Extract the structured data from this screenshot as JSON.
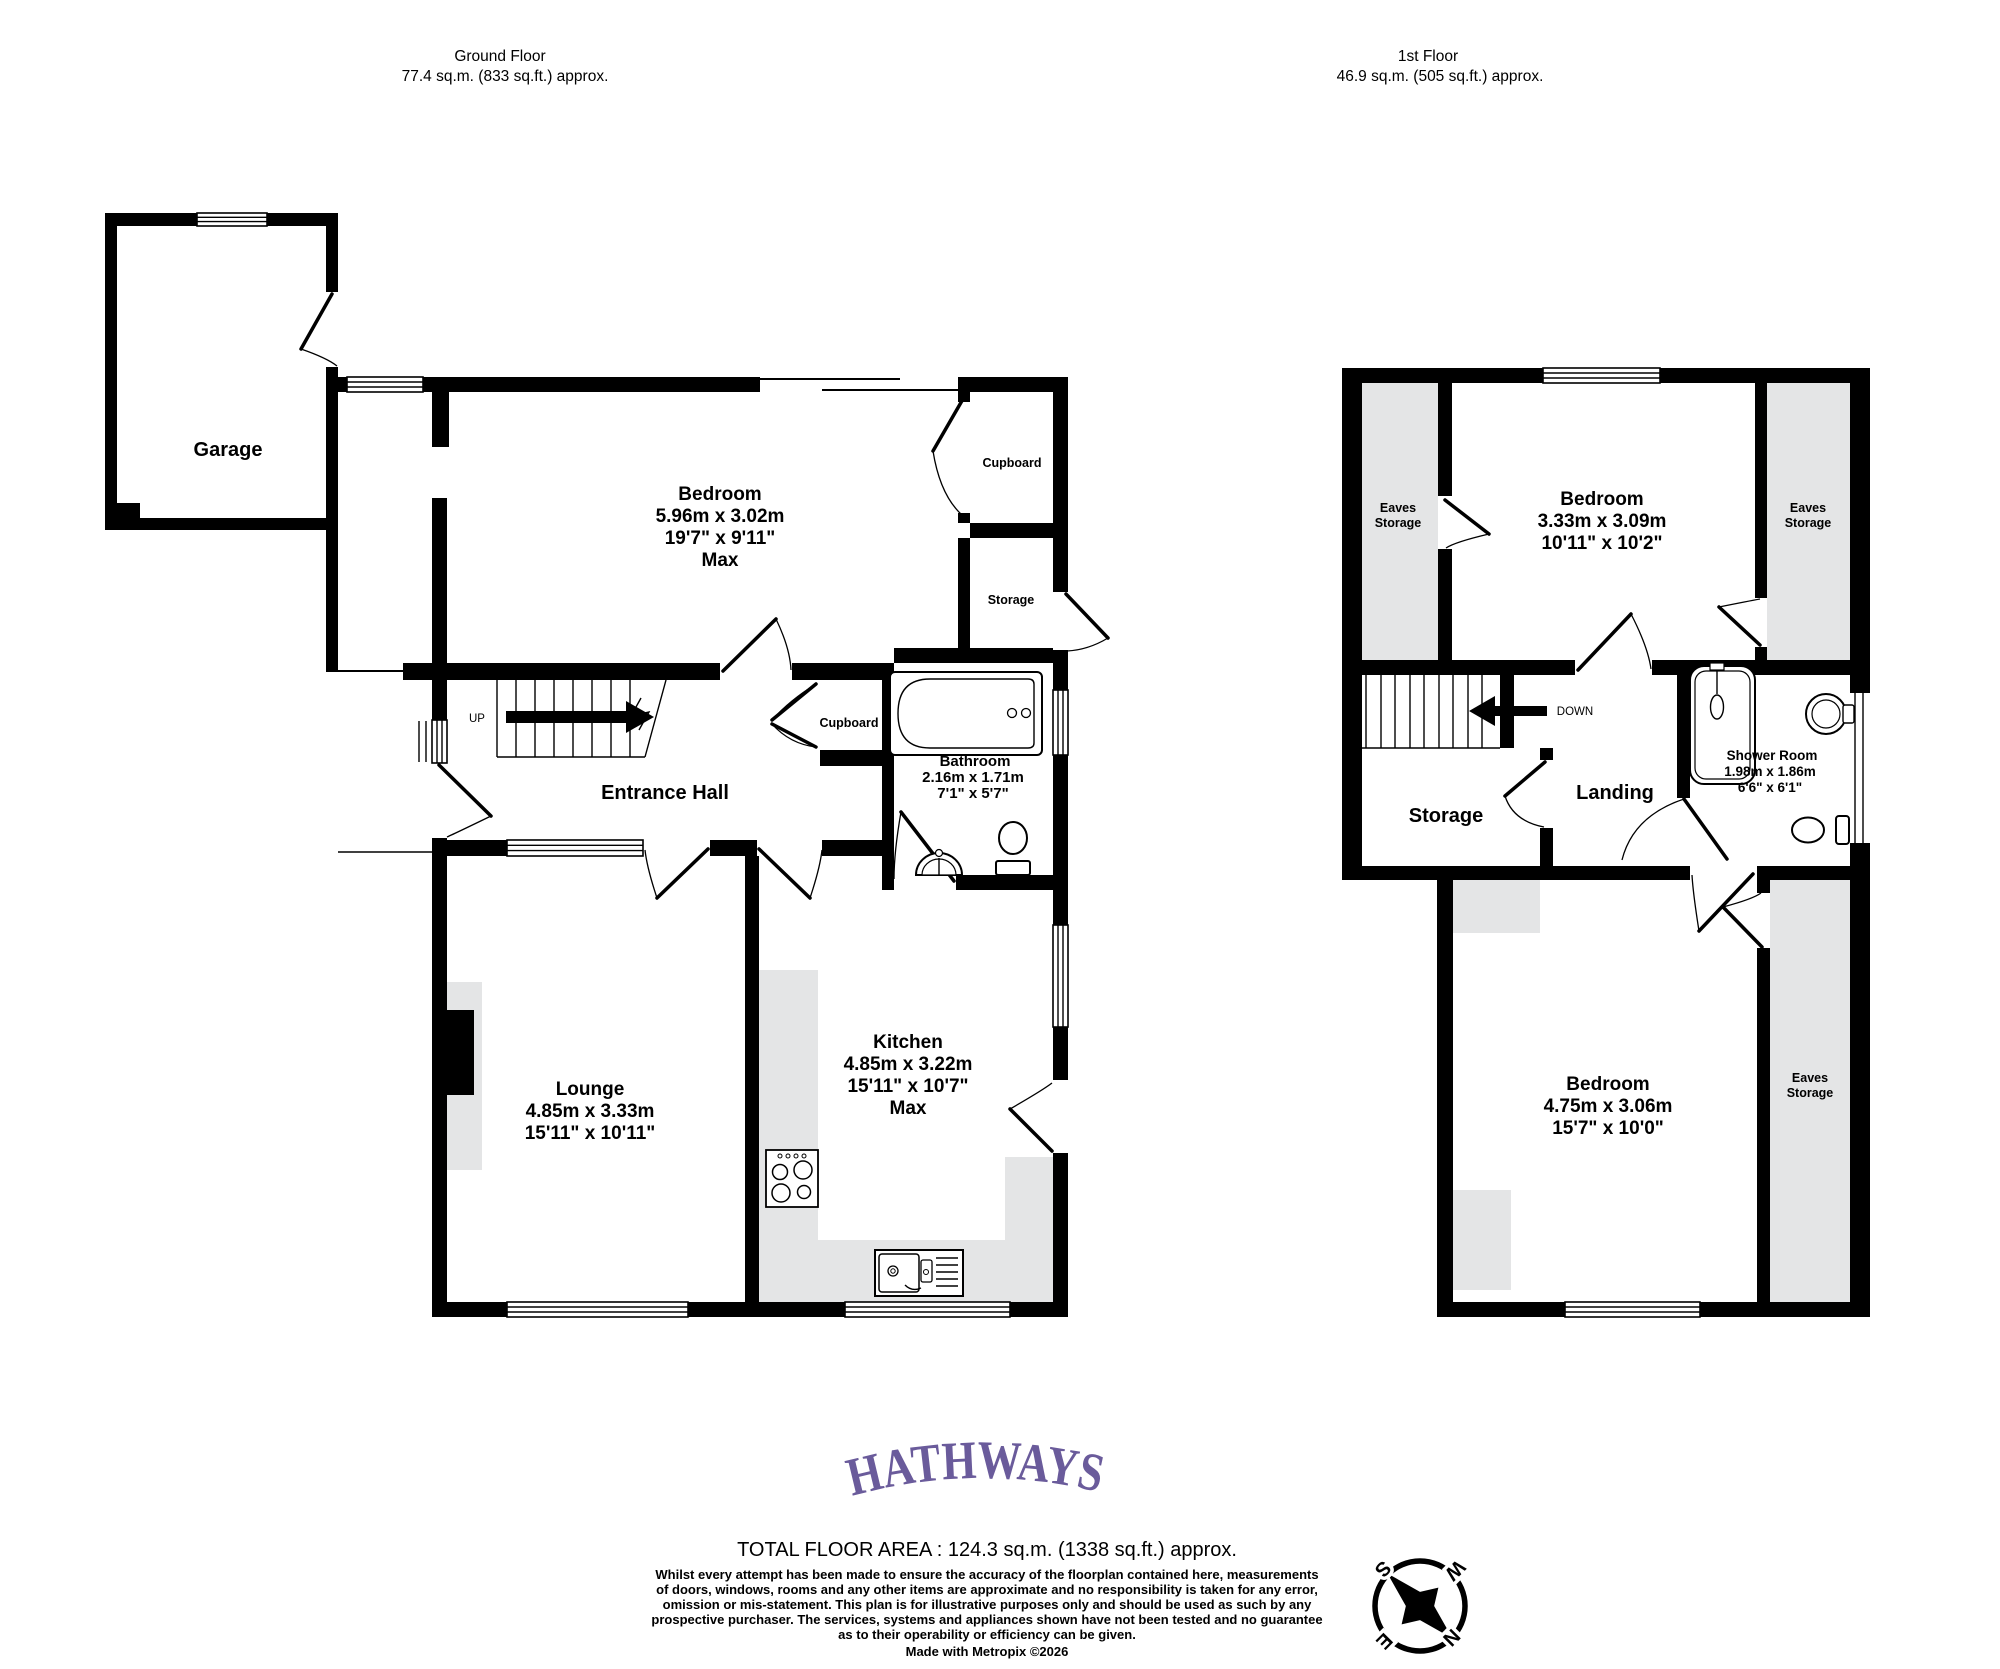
{
  "colors": {
    "wall": "#000000",
    "eaves_grey": "#e4e5e6",
    "brand_purple": "#6a5b9b"
  },
  "gf": {
    "title": "Ground Floor",
    "area": "77.4 sq.m. (833 sq.ft.) approx.",
    "garage": "Garage",
    "bedroom": [
      "Bedroom",
      "5.96m  x 3.02m",
      "19'7\"  x 9'11\"",
      "Max"
    ],
    "cupboard_top": "Cupboard",
    "storage_right": "Storage",
    "up": "UP",
    "entrance_hall": "Entrance Hall",
    "cupboard_hall": "Cupboard",
    "bathroom": [
      "Bathroom",
      "2.16m  x 1.71m",
      "7'1\"  x 5'7\""
    ],
    "kitchen": [
      "Kitchen",
      "4.85m  x 3.22m",
      "15'11\"  x 10'7\"",
      "Max"
    ],
    "lounge": [
      "Lounge",
      "4.85m  x 3.33m",
      "15'11\"  x 10'11\""
    ]
  },
  "ff": {
    "title": "1st Floor",
    "area": "46.9 sq.m. (505 sq.ft.) approx.",
    "eaves": [
      "Eaves",
      "Storage"
    ],
    "bedroom_top": [
      "Bedroom",
      "3.33m  x 3.09m",
      "10'11\"  x 10'2\""
    ],
    "down": "DOWN",
    "storage": "Storage",
    "landing": "Landing",
    "shower": [
      "Shower Room",
      "1.98m  x 1.86m",
      "6'6\"  x 6'1\""
    ],
    "bedroom_bottom": [
      "Bedroom",
      "4.75m  x 3.06m",
      "15'7\"  x 10'0\""
    ]
  },
  "footer": {
    "brand": "HATHWAYS",
    "total": "TOTAL FLOOR AREA : 124.3 sq.m. (1338 sq.ft.) approx.",
    "disclaimer": [
      "Whilst every attempt has been made to ensure the accuracy of the floorplan contained here, measurements",
      "of doors, windows, rooms and any other items are approximate and no responsibility is taken for any error,",
      "omission or mis-statement. This plan is for illustrative purposes only and should be used as such by any",
      "prospective purchaser. The services, systems and appliances shown have not been tested and no guarantee",
      "as to their operability or efficiency can be given."
    ],
    "made": "Made with Metropix ©2026"
  },
  "compass": {
    "n": "N",
    "e": "E",
    "s": "S",
    "w": "W"
  }
}
